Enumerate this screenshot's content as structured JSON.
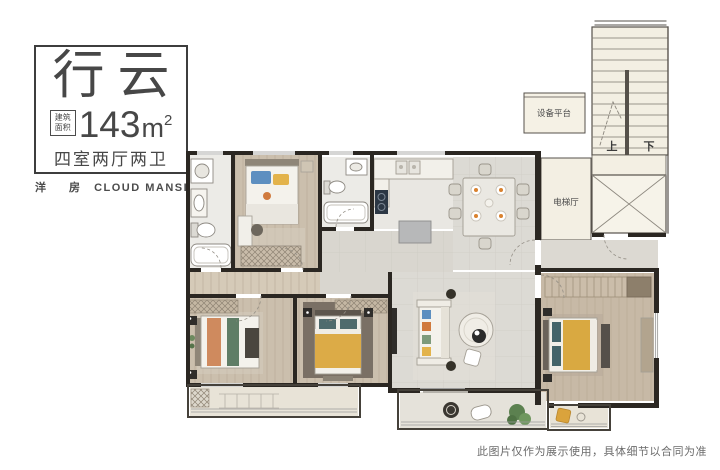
{
  "title_card": {
    "name": "行云",
    "area_label": "建筑面积",
    "area_value": "143",
    "area_unit": "m",
    "area_sup": "2",
    "spec": "四室两厅两卫"
  },
  "brand": {
    "cn": "洋 房",
    "en": "CLOUD MANSION"
  },
  "plan_labels": {
    "up": "上",
    "down": "下",
    "elevator_hall": "电梯厅",
    "equipment_platform": "设备平台"
  },
  "disclaimer": "此图片仅作为展示使用，具体细节以合同为准",
  "colors": {
    "wall": "#2b2722",
    "wood_floor": "#cbbfad",
    "corridor_floor": "#d5cab8",
    "tile_floor": "#ecebe7",
    "living_floor": "#dcdad4",
    "core_floor": "#f3efe3",
    "accent_yellow": "#d9a941",
    "accent_blue": "#5d8fc0",
    "accent_orange": "#cf8a5e",
    "accent_green": "#5f7d66",
    "text_dark": "#474747",
    "text_gray": "#6b6b6b"
  }
}
